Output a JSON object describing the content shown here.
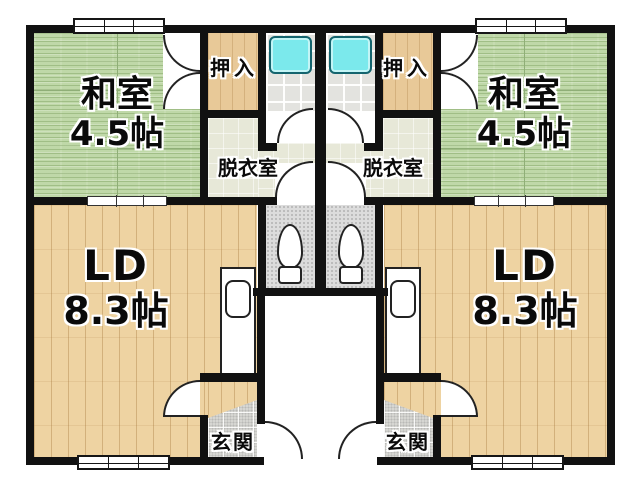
{
  "plan": {
    "kind": "Japanese duplex apartment floor plan with two mirrored units",
    "colors": {
      "wall": "#111111",
      "tatami_green": "#bfd8a8",
      "wood_floor": "#eed3a2",
      "closet_wood": "#e8c998",
      "bath_tile": "#e3e3df",
      "bathtub_cyan": "#7be9ec",
      "dressing_floor": "#e7e8d8",
      "toilet_floor": "#dcdcdc",
      "entry_tile": "#d6d6d2"
    },
    "units": [
      {
        "side": "left",
        "washitsu_name": "和室",
        "washitsu_size": "4.5帖",
        "ld_name": "LD",
        "ld_size": "8.3帖",
        "oshiire_label": "押入",
        "datsuishitsu_label": "脱衣室",
        "genkan_label": "玄関"
      },
      {
        "side": "right",
        "washitsu_name": "和室",
        "washitsu_size": "4.5帖",
        "ld_name": "LD",
        "ld_size": "8.3帖",
        "oshiire_label": "押入",
        "datsuishitsu_label": "脱衣室",
        "genkan_label": "玄関"
      }
    ]
  }
}
